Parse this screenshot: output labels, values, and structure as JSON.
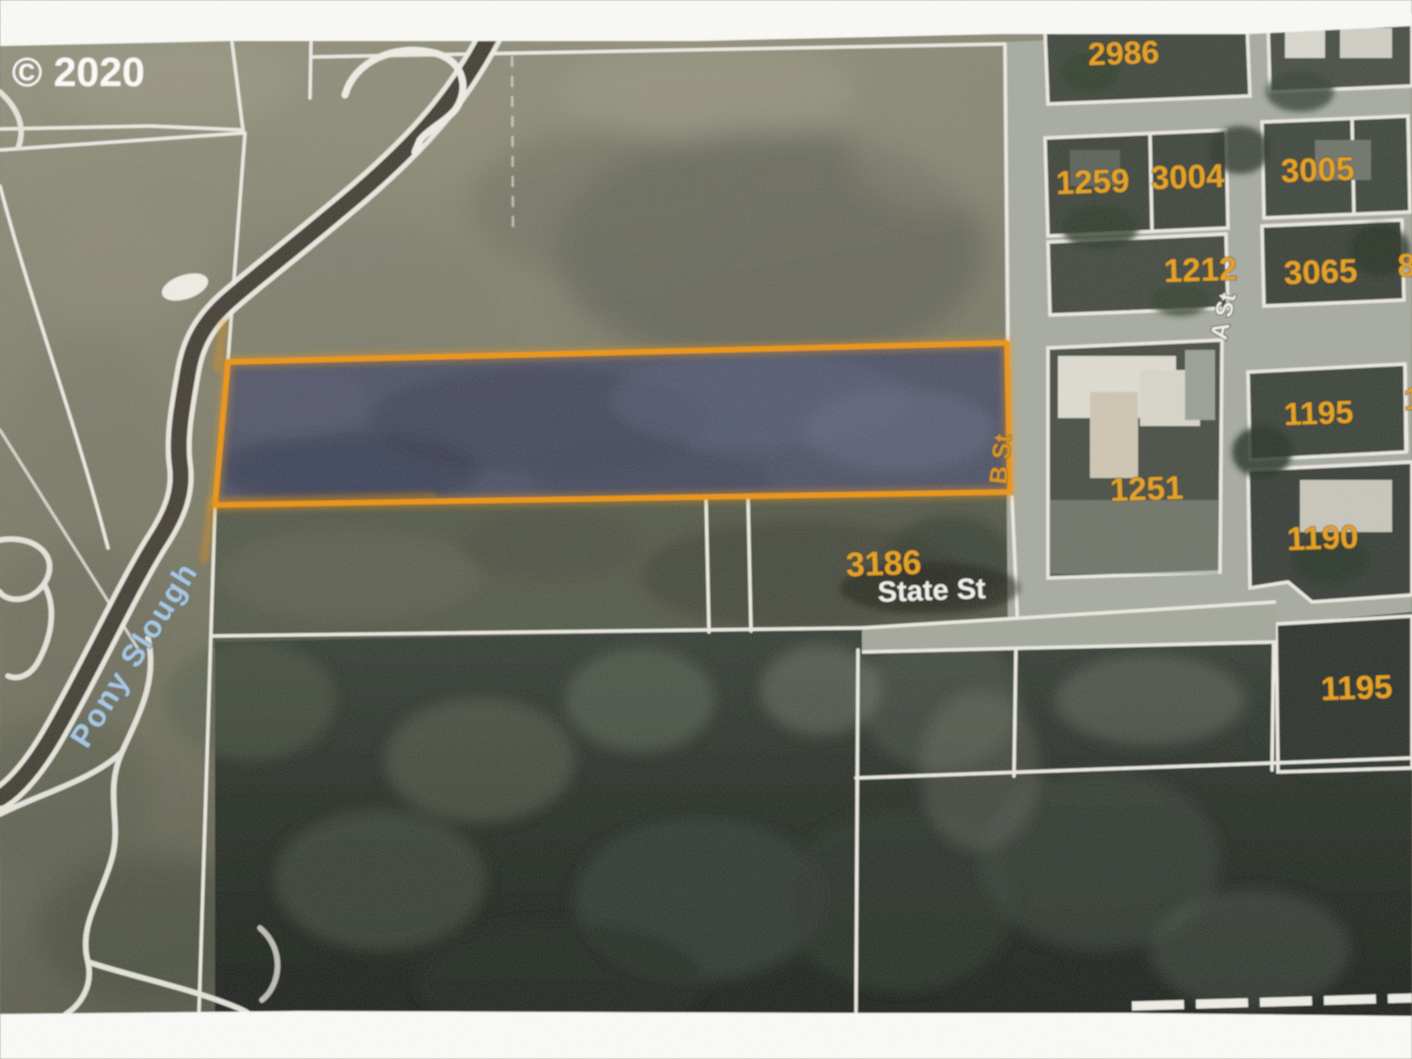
{
  "photo": {
    "copyright_watermark": "© 2020"
  },
  "map": {
    "type": "aerial-parcel-map",
    "waterway_label": "Pony Slough",
    "street_labels": [
      {
        "name": "A St"
      },
      {
        "name": "B St"
      },
      {
        "name": "State St"
      }
    ],
    "parcel_numbers": [
      "2986",
      "1259",
      "3004",
      "3005",
      "1212",
      "3065",
      "8",
      "1195",
      "1",
      "1251",
      "1190",
      "3186",
      "1195"
    ],
    "highlighted_parcel": {
      "outline_color": "#ee9411",
      "fill_color": "#4d5168"
    },
    "colors": {
      "parcel_number": "#e7a11f",
      "boundary_line": "#eceae2",
      "waterway_label": "#a9c7df",
      "street_label": "#f2f2ee"
    }
  }
}
